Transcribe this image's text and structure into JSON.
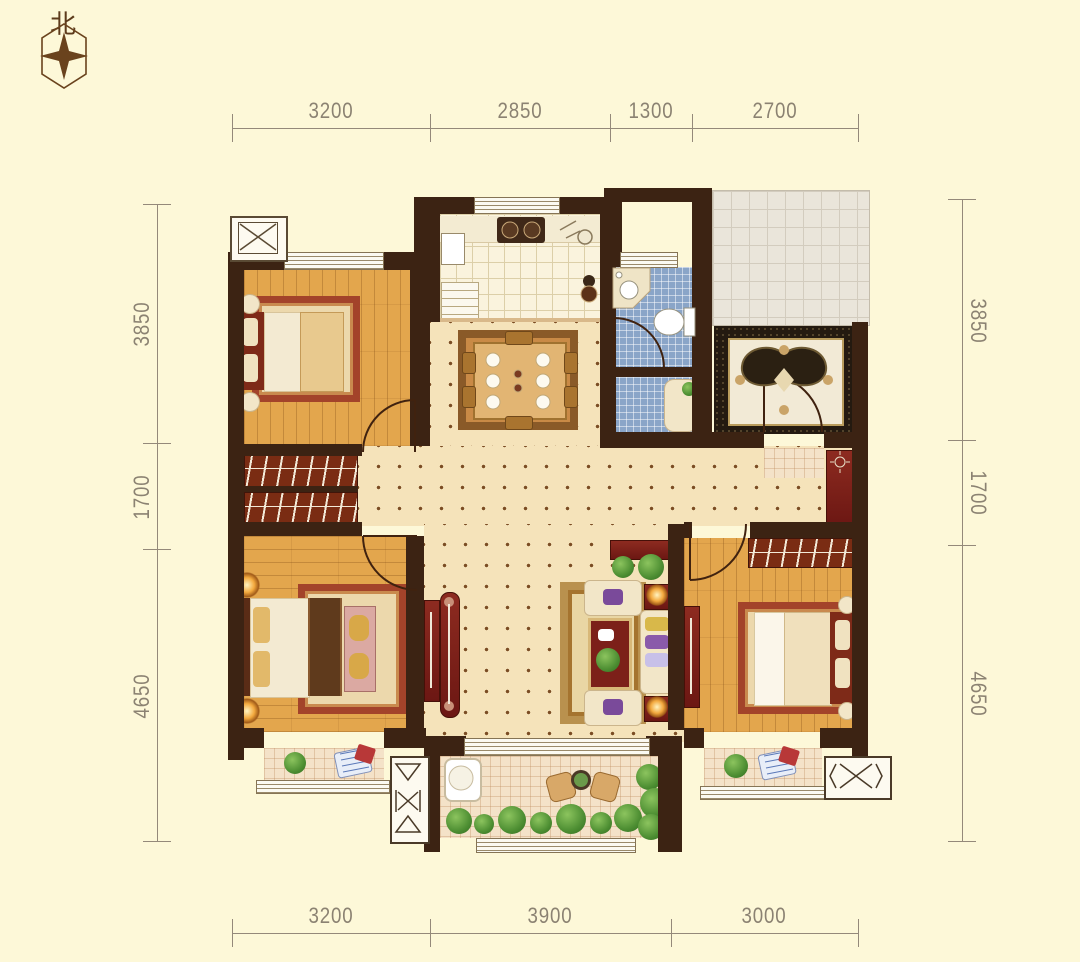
{
  "north_label": "北",
  "dimensions": {
    "top": [
      "3200",
      "2850",
      "1300",
      "2700"
    ],
    "bottom": [
      "3200",
      "3900",
      "3000"
    ],
    "left": [
      "3850",
      "1700",
      "4650"
    ],
    "right": [
      "3850",
      "1700",
      "4650"
    ]
  },
  "palette": {
    "background": "#fdf8d8",
    "wall": "#3c2313",
    "wood_floor": "#e3a64d",
    "hall_tile": "#f5e3ba",
    "kitchen_tile": "#faf3dd",
    "bath_tile": "#8aa5c8",
    "terrace_tile": "#eae5da",
    "cabinet_red": "#7c2019",
    "rug_border": "#a3432a",
    "entry_rug_dark": "#241a10",
    "dimension_line": "#94897a",
    "dimension_text": "#8b8272",
    "plant_green": "#4e8f33",
    "compass_brown": "#5d3b1c"
  },
  "icons": {
    "compass": "four-point-star-in-hexagon",
    "elevator": "box-with-cross",
    "flue": "box-with-hourglass-cross"
  }
}
